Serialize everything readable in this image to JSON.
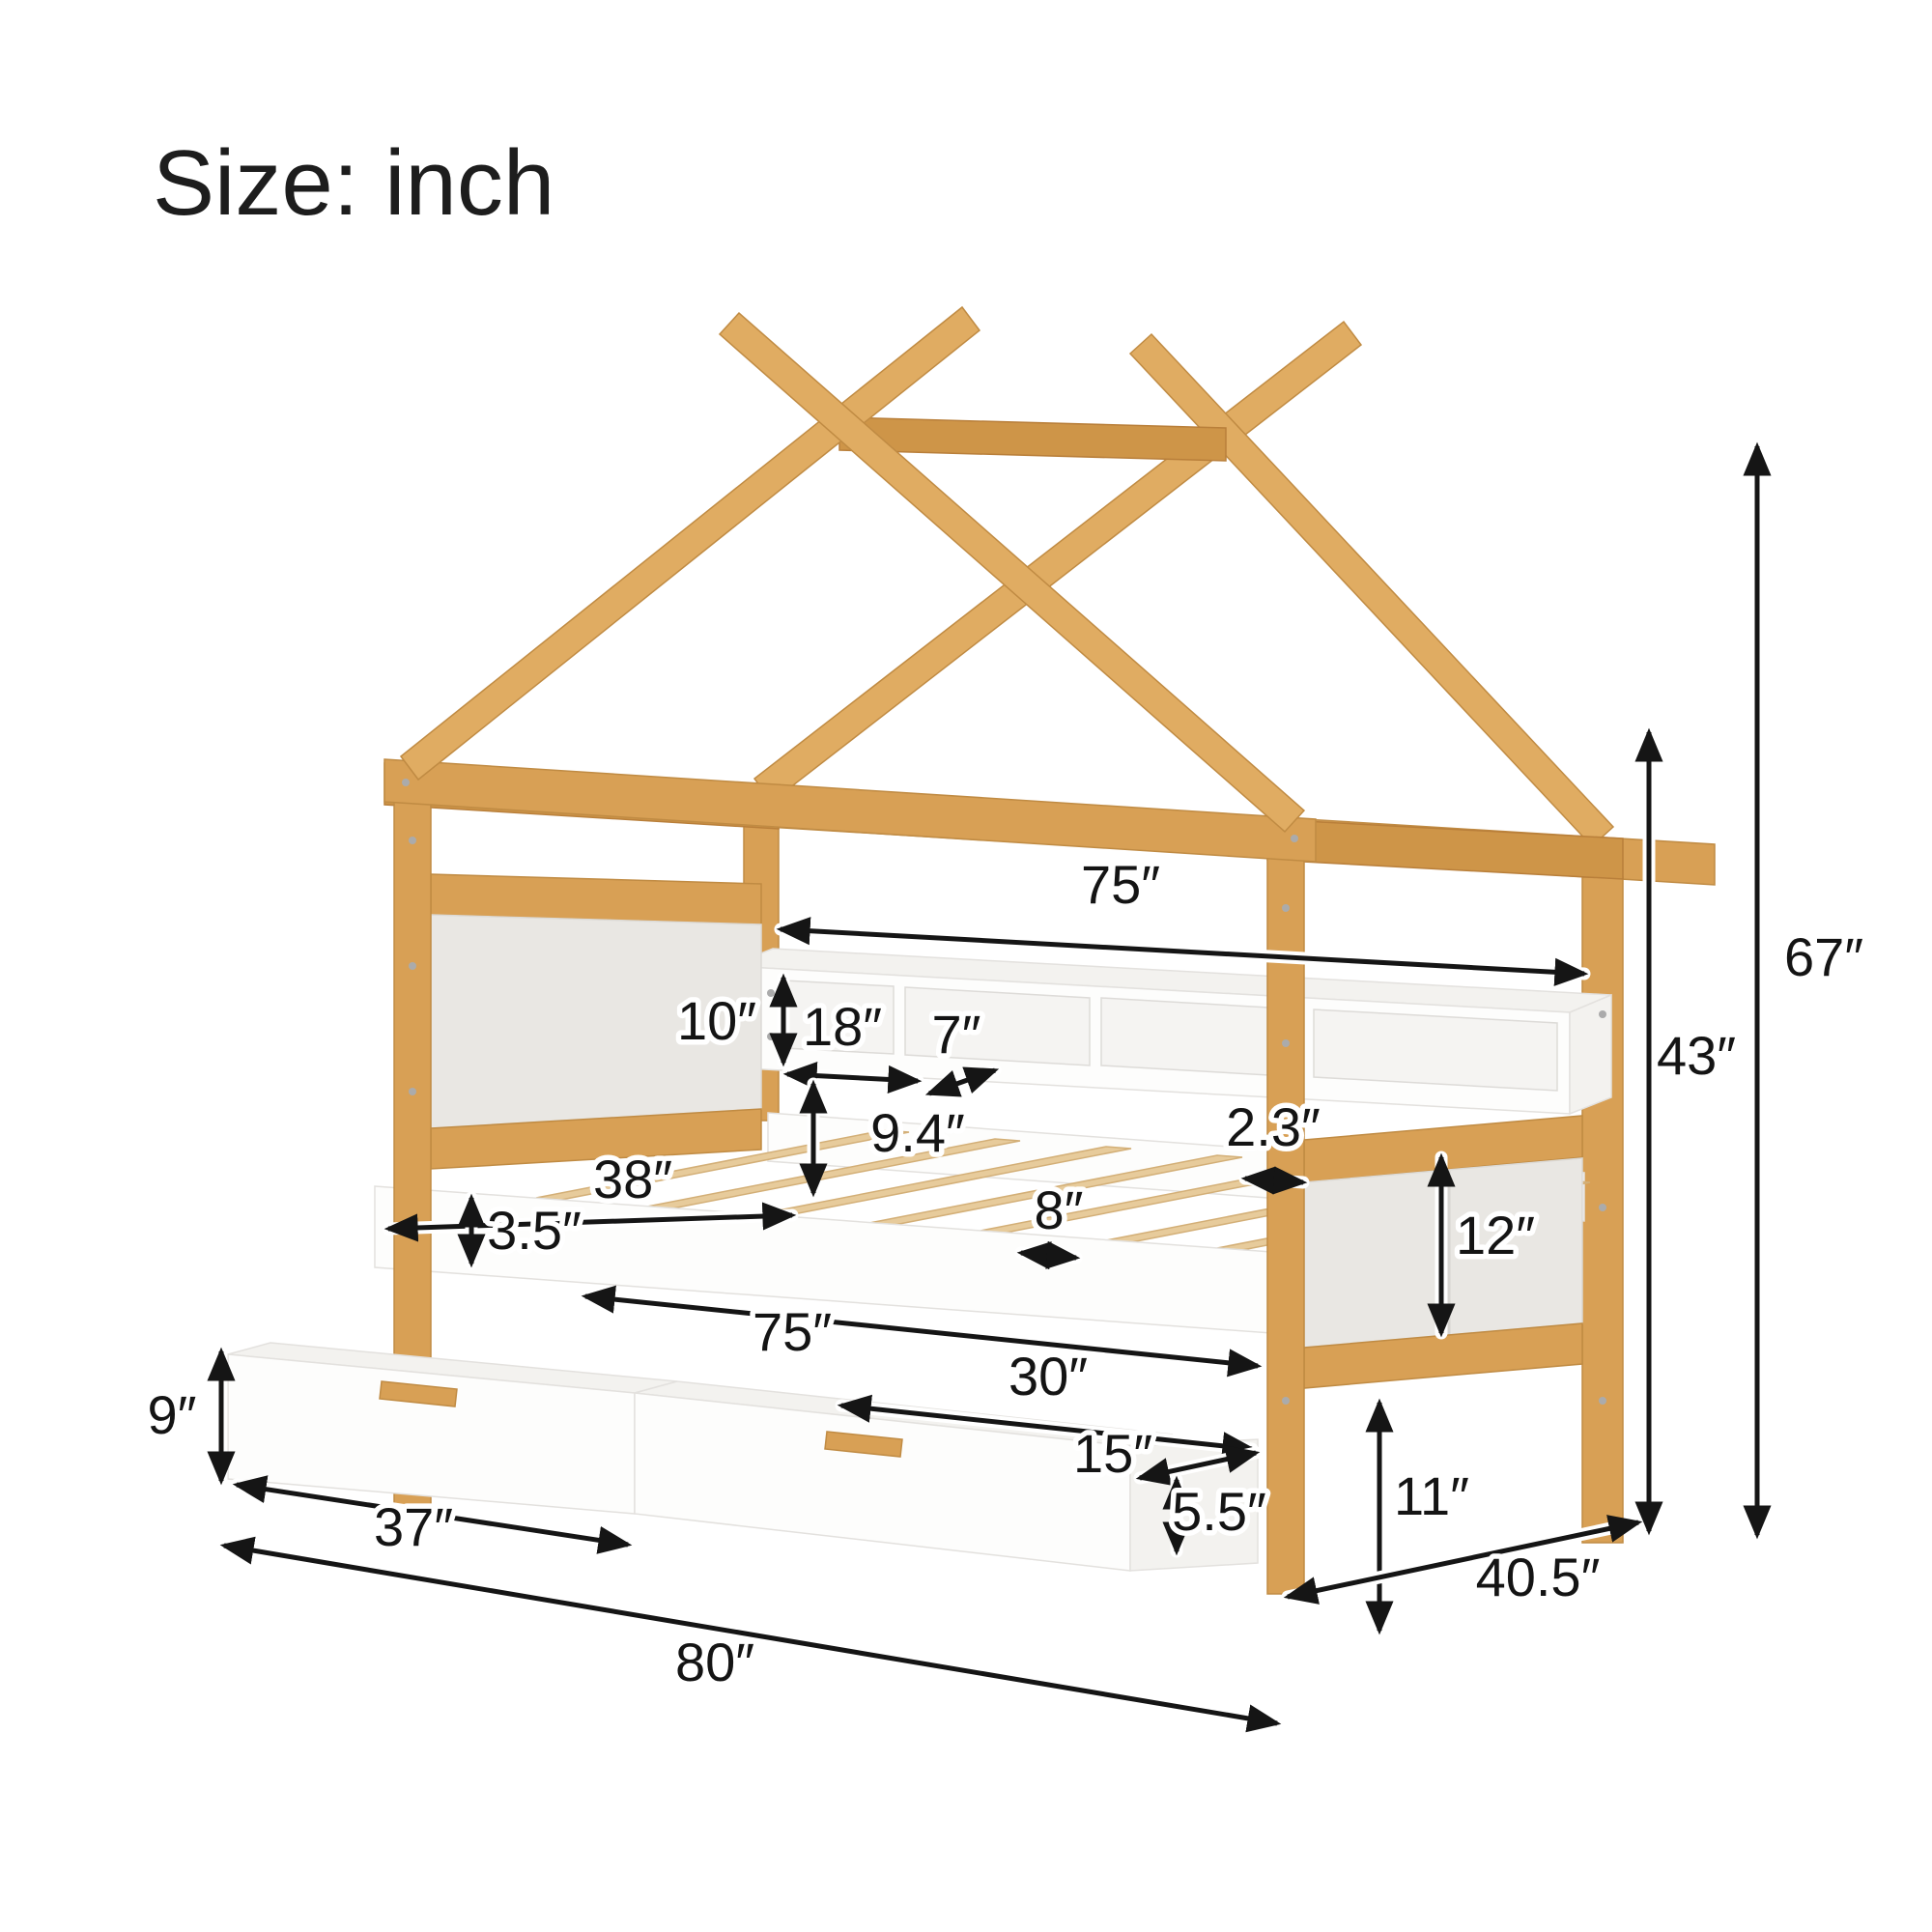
{
  "title": "Size: inch",
  "figure": {
    "subject": "house-frame bed with bookcase shelf, slat platform and two storage drawers",
    "colors": {
      "wood": "#D8A055",
      "white": "#FDFDFC",
      "panel": "#E9E7E3",
      "annotation": "#151515"
    }
  },
  "dims": {
    "shelf_length": "75″",
    "shelf_height": "10″",
    "cubby_width": "18″",
    "shelf_depth": "7″",
    "shelf_to_platform": "9.4″",
    "post_thickness": "2.3″",
    "inner_width": "38″",
    "rail_height": "3.5″",
    "bed_length": "75″",
    "slat_spacing": "8″",
    "footboard_panel_height": "12″",
    "drawer_top_length": "30″",
    "drawer_depth": "15″",
    "drawer_inner_height": "5.5″",
    "under_bed_clearance": "11″",
    "drawer_height": "9″",
    "drawer_front_width": "37″",
    "overall_width": "40.5″",
    "overall_height": "67″",
    "frame_height": "43″",
    "overall_length": "80″"
  }
}
